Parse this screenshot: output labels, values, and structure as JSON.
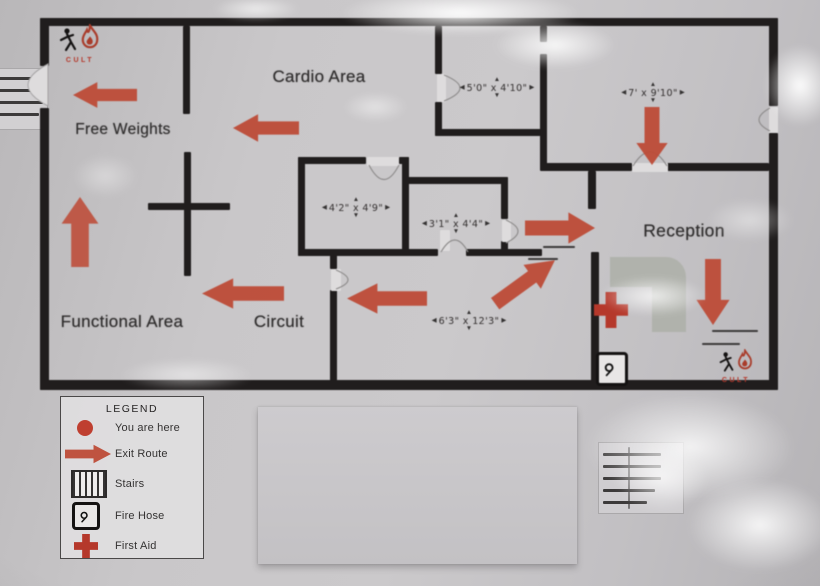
{
  "brand": {
    "name": "CULT"
  },
  "rooms": {
    "cardio": "Cardio Area",
    "free_weights": "Free Weights",
    "functional": "Functional Area",
    "circuit": "Circuit",
    "reception": "Reception"
  },
  "dims": {
    "d1": "5'0\" x 4'10\"",
    "d2": "7' x 9'10\"",
    "d3": "4'2\" x 4'9\"",
    "d4": "3'1\" x 4'4\"",
    "d5": "6'3\" x 12'3\""
  },
  "symbols": {
    "up": "▲",
    "down": "▼",
    "left": "◀",
    "right": "▶"
  },
  "legend": {
    "title": "LEGEND",
    "items": [
      {
        "icon": "you-are-here-dot",
        "label": "You are here"
      },
      {
        "icon": "exit-route-arrow",
        "label": "Exit Route"
      },
      {
        "icon": "stairs-icon",
        "label": "Stairs"
      },
      {
        "icon": "fire-hose-icon",
        "label": "Fire Hose"
      },
      {
        "icon": "first-aid-cross",
        "label": "First Aid"
      }
    ]
  },
  "colors": {
    "arrow_red": "#bd4b37",
    "wall_black": "#201d1d",
    "cross_red": "#b5382b",
    "desk_gray": "#b0b2ac",
    "paper_gray": "#c7c5c7"
  }
}
